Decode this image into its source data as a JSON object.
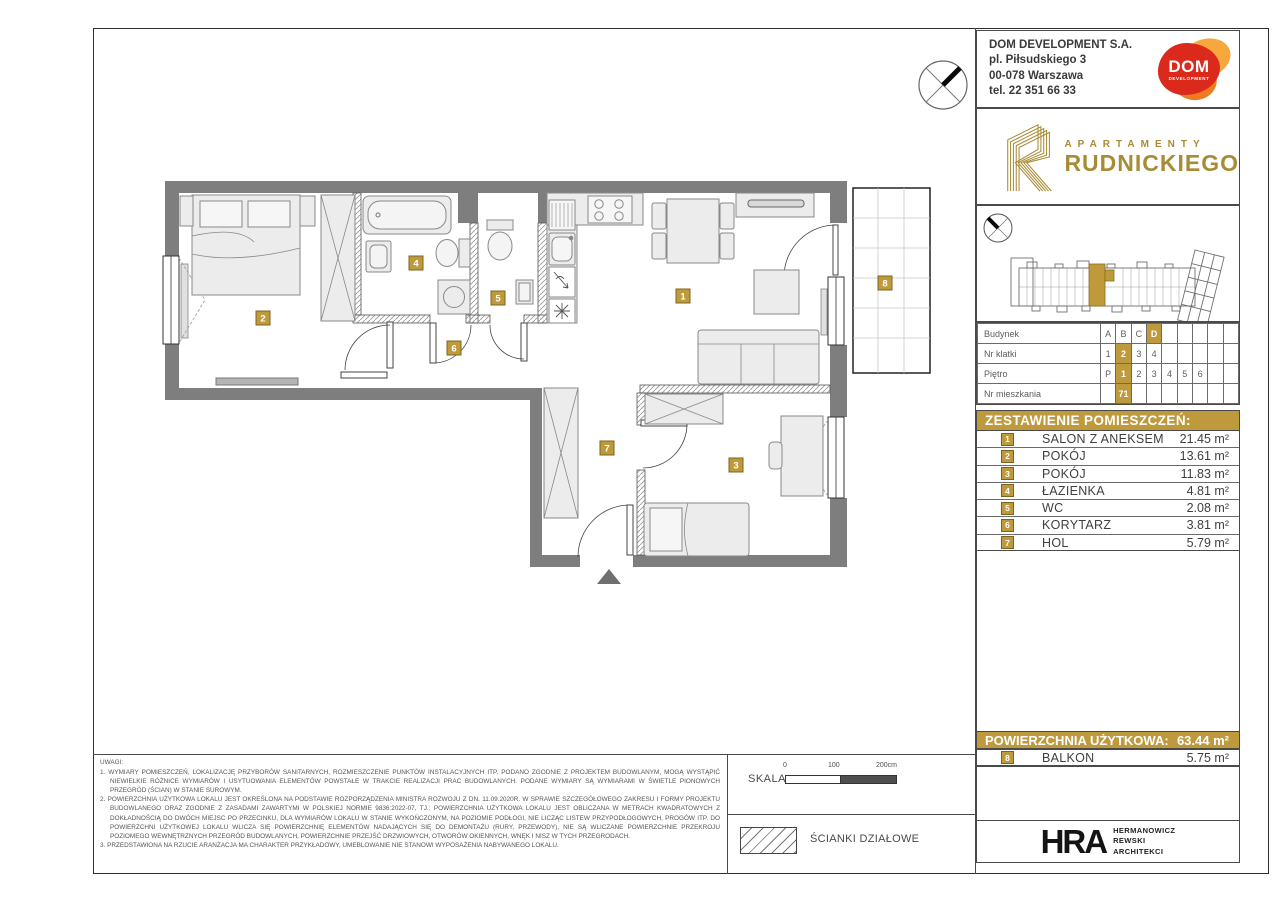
{
  "developer": {
    "name": "DOM DEVELOPMENT S.A.",
    "address_line1": "pl. Piłsudskiego 3",
    "address_line2": "00-078 Warszawa",
    "phone": "tel. 22 351 66 33",
    "logo_text": "DOM",
    "logo_subtext": "DEVELOPMENT"
  },
  "project": {
    "brand_top": "APARTAMENTY",
    "brand_name": "RUDNICKIEGO"
  },
  "unit_table": {
    "rows": [
      {
        "label": "Budynek",
        "cells": [
          "A",
          "B",
          "C",
          "D",
          "",
          "",
          "",
          "",
          ""
        ],
        "highlight": 3
      },
      {
        "label": "Nr klatki",
        "cells": [
          "1",
          "2",
          "3",
          "4",
          "",
          "",
          "",
          "",
          ""
        ],
        "highlight": 1
      },
      {
        "label": "Piętro",
        "cells": [
          "P",
          "1",
          "2",
          "3",
          "4",
          "5",
          "6",
          "",
          ""
        ],
        "highlight": 1
      },
      {
        "label": "Nr mieszkania",
        "cells": [
          "",
          "71",
          "",
          "",
          "",
          "",
          "",
          "",
          ""
        ],
        "highlight": 1
      }
    ]
  },
  "rooms": {
    "header": "ZESTAWIENIE POMIESZCZEŃ:",
    "items": [
      {
        "num": "1",
        "name": "SALON Z ANEKSEM",
        "area": "21.45 m²"
      },
      {
        "num": "2",
        "name": "POKÓJ",
        "area": "13.61 m²"
      },
      {
        "num": "3",
        "name": "POKÓJ",
        "area": "11.83 m²"
      },
      {
        "num": "4",
        "name": "ŁAZIENKA",
        "area": "4.81 m²"
      },
      {
        "num": "5",
        "name": "WC",
        "area": "2.08 m²"
      },
      {
        "num": "6",
        "name": "KORYTARZ",
        "area": "3.81 m²"
      },
      {
        "num": "7",
        "name": "HOL",
        "area": "5.79 m²"
      }
    ]
  },
  "summary": {
    "label": "POWIERZCHNIA UŻYTKOWA:",
    "value": "63.44 m²",
    "balcony": {
      "num": "8",
      "name": "BALKON",
      "area": "5.75 m²"
    }
  },
  "architect": {
    "logo": "HRA",
    "lines": [
      "HERMANOWICZ",
      "REWSKI",
      "ARCHITEKCI"
    ]
  },
  "notes": {
    "title": "UWAGI:",
    "items": [
      "1.  WYMIARY POMIESZCZEŃ, LOKALIZACJĘ PRZYBORÓW SANITARNYCH, ROZMIESZCZENIE PUNKTÓW INSTALACYJNYCH ITP. PODANO ZGODNIE Z PROJEKTEM BUDOWLANYM, MOGĄ WYSTĄPIĆ NIEWIELKIE RÓŻNICE WYMIARÓW I USYTUOWANIA ELEMENTÓW POWSTAŁE W TRAKCIE REALIZACJI PRAC BUDOWLANYCH. PODANE WYMIARY SĄ WYMIARAMI W ŚWIETLE PIONOWYCH PRZEGRÓD (ŚCIAN) W STANIE SUROWYM.",
      "2.  POWIERZCHNIA UŻYTKOWA LOKALU JEST OKREŚLONA NA PODSTAWIE ROZPORZĄDZENIA MINISTRA ROZWOJU Z DN. 11.09.2020R. W SPRAWIE SZCZEGÓŁOWEGO ZAKRESU I FORMY PROJEKTU BUDOWLANEGO ORAZ ZGODNIE Z ZASADAMI ZAWARTYMI W POLSKIEJ NORMIE 9836:2022-07, TJ.: POWIERZCHNIA UŻYTKOWA LOKALU JEST OBLICZANA W METRACH KWADRATOWYCH Z DOKŁADNOŚCIĄ DO DWÓCH MIEJSC PO PRZECINKU, DLA WYMIARÓW LOKALU W STANIE WYKOŃCZONYM, NA POZIOMIE PODŁOGI, NIE LICZĄC LISTEW PRZYPODŁOGOWYCH, PROGÓW ITP. DO POWIERZCHNI UŻYTKOWEJ LOKALU WLICZA SIĘ POWIERZCHNIĘ ELEMENTÓW NADAJĄCYCH SIĘ DO DEMONTAŻU (RURY, PRZEWODY), NIE SĄ WLICZANE POWIERZCHNIE PRZEKROJU POZIOMEGO WEWNĘTRZNYCH PRZEGRÓD BUDOWLANYCH, POWIERZCHNIE PRZEJŚĆ DRZWIOWYCH, OTWORÓW OKIENNYCH, WNĘK I NISZ W TYCH PRZEGRODACH.",
      "3.  PRZEDSTAWIONA NA RZUCIE ARANŻACJA MA CHARAKTER PRZYKŁADOWY, UMEBLOWANIE NIE STANOWI WYPOSAŻENIA NABYWANEGO LOKALU."
    ]
  },
  "scale": {
    "label": "SKALA:",
    "ticks": [
      "0",
      "100",
      "200cm"
    ]
  },
  "legend": {
    "partition_label": "ŚCIANKI DZIAŁOWE"
  },
  "plan": {
    "labels": [
      "1",
      "2",
      "3",
      "4",
      "5",
      "6",
      "7",
      "8"
    ]
  },
  "colors": {
    "gold": "#BE9A3C",
    "wall": "#7E7E7E",
    "logo_gold": "#A88C35",
    "dom_red": "#DB2A1C"
  }
}
